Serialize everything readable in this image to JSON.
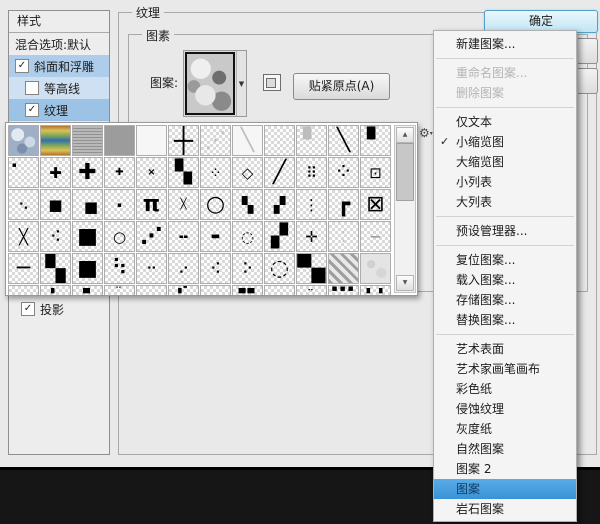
{
  "dialog": {
    "texture_group_label": "纹理",
    "elements_group_label": "图素",
    "pattern_label": "图案:",
    "snap_button_label": "贴紧原点(A)",
    "ok_button_label": "确定"
  },
  "styles_panel": {
    "title": "样式",
    "items": [
      {
        "label": "混合选项:默认",
        "type": "plain"
      },
      {
        "label": "斜面和浮雕",
        "type": "check",
        "checked": true,
        "highlight": "med",
        "indent": false
      },
      {
        "label": "等高线",
        "type": "check",
        "checked": false,
        "highlight": "pale",
        "indent": true
      },
      {
        "label": "纹理",
        "type": "check",
        "checked": true,
        "highlight": "strong",
        "indent": true
      }
    ],
    "bottom_item": {
      "label": "投影",
      "checked": true
    }
  },
  "icons": {
    "checkbox_check": "✓",
    "menu_check": "✓",
    "dropdown_arrow": "▼",
    "gear": "⚙",
    "gear_caret": "▾",
    "scroll_up": "▲",
    "scroll_down": "▼"
  },
  "pattern_picker": {
    "rows": [
      [
        {
          "k": "photo1"
        },
        {
          "k": "photo2"
        },
        {
          "k": "photo3"
        },
        {
          "k": "solid"
        },
        {
          "k": "blank"
        },
        {
          "g": "┼",
          "c": "g-thin g-ink"
        },
        {
          "g": "⋰",
          "c": "g-faint g-big"
        },
        {
          "g": "╲",
          "c": "g-faint g-big",
          "k": "blank"
        },
        {},
        {
          "g": "▘",
          "c": "g-faint g-big"
        },
        {
          "g": "╲",
          "c": "g-bold g-big g-ink"
        },
        {
          "g": "▘",
          "c": "g-big g-ink"
        }
      ],
      [
        {
          "g": "▪",
          "c": "g-tl g-tiny g-ink"
        },
        {
          "g": "✚",
          "c": "g-mid g-ink"
        },
        {
          "g": "✚",
          "c": "g-big g-ink"
        },
        {
          "g": "✚",
          "c": "g-small g-ink"
        },
        {
          "g": "×",
          "c": "g-small g-ink g-bold"
        },
        {
          "g": "▚",
          "c": "g-big g-ink"
        },
        {
          "g": "⁘",
          "c": "g-mid g-ink"
        },
        {
          "g": "◇",
          "c": "g-mid g-ink"
        },
        {
          "g": "╱",
          "c": "g-big g-bold g-ink"
        },
        {
          "g": "⠿",
          "c": "g-mid g-ink"
        },
        {
          "g": "⁘",
          "c": "g-big g-ink"
        },
        {
          "g": "⊡",
          "c": "g-mid g-ink"
        }
      ],
      [
        {
          "g": "⠢",
          "c": "g-mid g-ink"
        },
        {
          "g": "■",
          "c": "g-mid g-ink"
        },
        {
          "g": "■",
          "c": "g-mid g-ink g-off"
        },
        {
          "g": "▪",
          "c": "g-tiny g-ink"
        },
        {
          "g": "π",
          "c": "g-big g-ink g-bold"
        },
        {
          "g": "╳",
          "c": "g-small g-ink"
        },
        {
          "g": "○",
          "c": "g-big g-ink"
        },
        {
          "g": "▚",
          "c": "g-mid g-ink"
        },
        {
          "g": "▞",
          "c": "g-mid g-ink"
        },
        {
          "g": "⋮",
          "c": "g-mid g-ink"
        },
        {
          "g": "┏",
          "c": "g-big g-ink g-bold"
        },
        {
          "g": "⊠",
          "c": "g-big g-ink"
        }
      ],
      [
        {
          "g": "╳",
          "c": "g-mid g-ink"
        },
        {
          "g": "⠪",
          "c": "g-mid g-ink"
        },
        {
          "g": "■",
          "c": "g-big g-ink"
        },
        {
          "g": "○",
          "c": "g-mid g-ink"
        },
        {
          "g": "⋰",
          "c": "g-big g-ink g-bold"
        },
        {
          "g": "╍",
          "c": "g-mid g-ink"
        },
        {
          "g": "▬",
          "c": "g-small g-ink"
        },
        {
          "g": "◌",
          "c": "g-mid g-ink"
        },
        {
          "g": "▞",
          "c": "g-big g-ink"
        },
        {
          "g": "✛",
          "c": "g-mid g-ink"
        },
        {
          "g": "⁚",
          "c": "g-faint g-mid"
        },
        {
          "g": "─",
          "c": "g-gray g-mid"
        }
      ],
      [
        {
          "g": "─",
          "c": "g-bold g-ink g-big"
        },
        {
          "g": "▚",
          "c": "g-huge g-ink"
        },
        {
          "g": "■",
          "c": "g-big g-ink"
        },
        {
          "g": "⠳",
          "c": "g-big g-ink"
        },
        {
          "g": "⠒",
          "c": "g-mid g-ink"
        },
        {
          "g": "⠔",
          "c": "g-mid g-ink"
        },
        {
          "g": "⠪",
          "c": "g-mid g-ink"
        },
        {
          "g": "⠕",
          "c": "g-mid g-ink"
        },
        {
          "g": "◌",
          "c": "g-big g-ink"
        },
        {
          "g": "▚",
          "c": "g-full g-ink"
        },
        {
          "k": "hatch"
        },
        {
          "k": "mottle"
        }
      ],
      [
        {
          "g": "",
          "c": "g-cut"
        },
        {
          "g": "▖",
          "c": "g-cut g-ink"
        },
        {
          "g": "▄",
          "c": "g-cut g-ink"
        },
        {
          "g": "⠒",
          "c": "g-cut g-ink"
        },
        {
          "g": "",
          "c": "g-cut"
        },
        {
          "g": "▗▘",
          "c": "g-cut g-ink"
        },
        {
          "g": "",
          "c": "g-cut"
        },
        {
          "g": "▄▄",
          "c": "g-cut g-ink"
        },
        {
          "g": "",
          "c": "g-cut"
        },
        {
          "g": "⠤",
          "c": "g-cut g-ink"
        },
        {
          "g": "▪▪▪",
          "c": "g-cut g-ink"
        },
        {
          "g": "▖▗",
          "c": "g-cut g-ink"
        }
      ]
    ]
  },
  "context_menu": {
    "items": [
      {
        "label": "新建图案...",
        "type": "item"
      },
      {
        "type": "sep"
      },
      {
        "label": "重命名图案...",
        "type": "item",
        "disabled": true
      },
      {
        "label": "删除图案",
        "type": "item",
        "disabled": true
      },
      {
        "type": "sep"
      },
      {
        "label": "仅文本",
        "type": "item"
      },
      {
        "label": "小缩览图",
        "type": "item",
        "checked": true
      },
      {
        "label": "大缩览图",
        "type": "item"
      },
      {
        "label": "小列表",
        "type": "item"
      },
      {
        "label": "大列表",
        "type": "item"
      },
      {
        "type": "sep"
      },
      {
        "label": "预设管理器...",
        "type": "item"
      },
      {
        "type": "sep"
      },
      {
        "label": "复位图案...",
        "type": "item"
      },
      {
        "label": "载入图案...",
        "type": "item"
      },
      {
        "label": "存储图案...",
        "type": "item"
      },
      {
        "label": "替换图案...",
        "type": "item"
      },
      {
        "type": "sep"
      },
      {
        "label": "艺术表面",
        "type": "item"
      },
      {
        "label": "艺术家画笔画布",
        "type": "item"
      },
      {
        "label": "彩色纸",
        "type": "item"
      },
      {
        "label": "侵蚀纹理",
        "type": "item"
      },
      {
        "label": "灰度纸",
        "type": "item"
      },
      {
        "label": "自然图案",
        "type": "item"
      },
      {
        "label": "图案 2",
        "type": "item"
      },
      {
        "label": "图案",
        "type": "item",
        "selected": true
      },
      {
        "label": "岩石图案",
        "type": "item"
      }
    ]
  },
  "colors": {
    "dialog_bg": "#e9e9e9",
    "highlight_medium": "#aecdea",
    "highlight_pale": "#cfe0f2",
    "highlight_strong": "#9cc2e5",
    "menu_selection": "#3a92d6",
    "ok_button_fill": "#c2e5f4",
    "canvas_dark": "#161616"
  }
}
